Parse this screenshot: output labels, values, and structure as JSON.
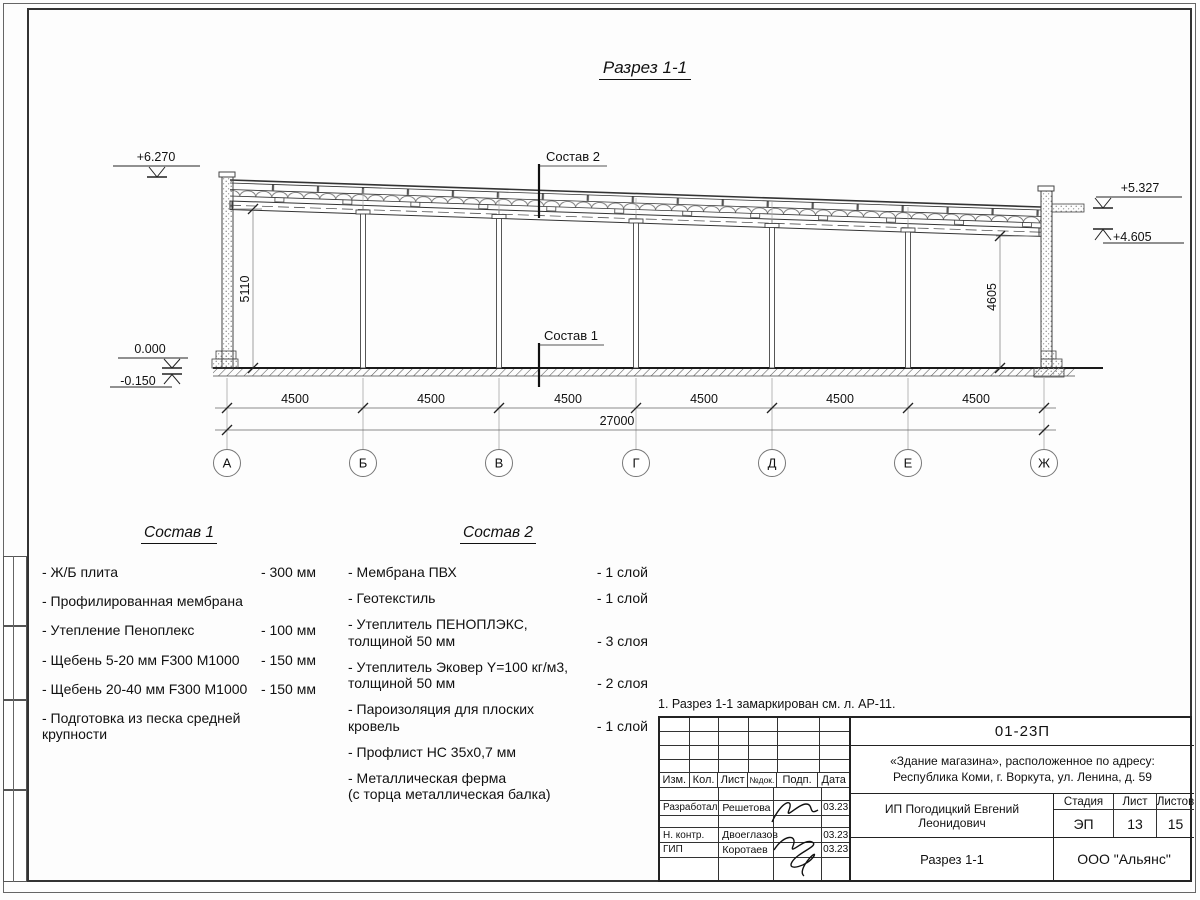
{
  "drawing_title": "Разрез 1-1",
  "section": {
    "callouts": {
      "sostav2": "Состав 2",
      "sostav1": "Состав 1"
    },
    "elevations": {
      "top_left": "+6.270",
      "right_top": "+5.327",
      "right_bottom": "+4.605",
      "zero": "0.000",
      "below": "-0.150"
    },
    "vertical_dims": {
      "left": "5110",
      "right": "4605"
    },
    "axes": [
      "А",
      "Б",
      "В",
      "Г",
      "Д",
      "Е",
      "Ж"
    ],
    "bay_dims": [
      "4500",
      "4500",
      "4500",
      "4500",
      "4500",
      "4500"
    ],
    "total_dim": "27000"
  },
  "sostav1": {
    "title": "Состав 1",
    "items": [
      {
        "name": "- Ж/Б плита",
        "value": "- 300 мм"
      },
      {
        "name": "- Профилированная мембрана",
        "value": ""
      },
      {
        "name": "- Утепление Пеноплекс",
        "value": "- 100 мм"
      },
      {
        "name": "-  Щебень 5-20 мм F300 М1000",
        "value": "- 150 мм"
      },
      {
        "name": "-  Щебень 20-40 мм F300 М1000",
        "value": "- 150 мм"
      },
      {
        "name": "- Подготовка из песка средней\n  крупности",
        "value": ""
      }
    ]
  },
  "sostav2": {
    "title": "Состав 2",
    "items": [
      {
        "name": "- Мембрана ПВХ",
        "value": "- 1 слой"
      },
      {
        "name": "- Геотекстиль",
        "value": "- 1 слой"
      },
      {
        "name": "- Утеплитель ПЕНОПЛЭКС,\n  толщиной 50 мм",
        "value": "- 3 слоя"
      },
      {
        "name": "- Утеплитель Эковер Y=100 кг/м3,\n  толщиной 50 мм",
        "value": "- 2 слоя"
      },
      {
        "name": "- Пароизоляция для плоских кровель",
        "value": "- 1 слой"
      },
      {
        "name": "- Профлист НС 35х0,7 мм",
        "value": ""
      },
      {
        "name": "- Металлическая ферма\n  (с торца металлическая балка)",
        "value": ""
      }
    ]
  },
  "note": "1. Разрез 1-1 замаркирован см. л. АР-11.",
  "titleblock": {
    "doc_number": "01-23П",
    "object_line1": "«Здание магазина», расположенное по адресу:",
    "object_line2": "Республика Коми, г. Воркута, ул. Ленина, д. 59",
    "header_cols": {
      "izm": "Изм.",
      "kol": "Кол.",
      "list": "Лист",
      "ndok": "№док.",
      "podp": "Подп.",
      "data": "Дата"
    },
    "rows": {
      "developed_role": "Разработал",
      "developed_name": "Решетова",
      "developed_date": "03.23",
      "ncontr_role": "Н. контр.",
      "ncontr_name": "Двоеглазов",
      "ncontr_date": "03.23",
      "gip_role": "ГИП",
      "gip_name": "Коротаев",
      "gip_date": "03.23"
    },
    "client": "ИП Погодицкий Евгений Леонидович",
    "stage_label": "Стадия",
    "sheet_label": "Лист",
    "sheets_label": "Листов",
    "stage": "ЭП",
    "sheet": "13",
    "sheets": "15",
    "sheet_title": "Разрез 1-1",
    "org": "ООО \"Альянс\""
  }
}
